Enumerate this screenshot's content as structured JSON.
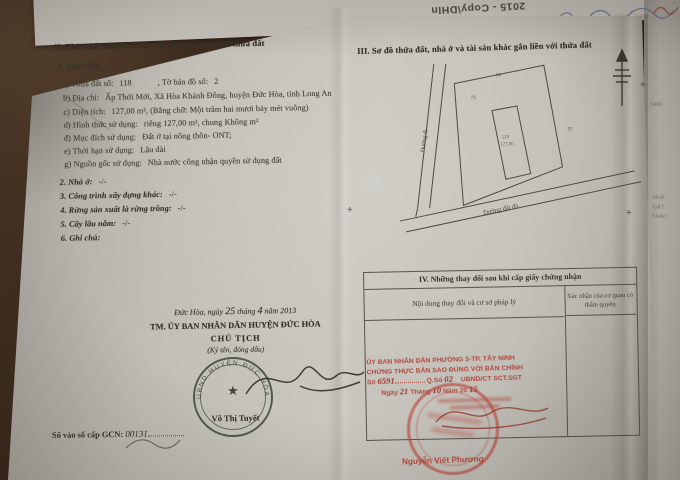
{
  "colors": {
    "backdrop_brown": "#3a2a1c",
    "paper": "#c6c3bc",
    "ink": "#45423b",
    "stamp_red": "#b2483d",
    "seal_dark": "#323d35"
  },
  "back_sheet": {
    "flipped_label": "2015 - Copy\\DHIn"
  },
  "edge_fragments": [
    "NAM",
    "NHA",
    "ĐẤT",
    "KHÁC"
  ],
  "section_ii": {
    "heading": "II. Thửa đất, nhà ở và tài sản khác gắn liền với thửa đất",
    "sub_heading": "1. Thửa đất:",
    "fields": [
      {
        "label": "a) Thửa đất số:",
        "value": "118",
        "label2": ", Tờ bản đồ số:",
        "value2": "2"
      },
      {
        "label": "b) Địa chỉ:",
        "value": "Ấp Thới Mới, Xã Hòa Khánh Đông, huyện Đức Hòa, tỉnh Long An"
      },
      {
        "label": "c) Diện tích:",
        "value": "127,00 m², (Bằng chữ: Một trăm hai mươi bảy mét vuông)"
      },
      {
        "label": "d) Hình thức sử dụng:",
        "value": "riêng 127,00    m², chung  Không    m²"
      },
      {
        "label": "đ) Mục đích sử dụng:",
        "value": "Đất ở tại nông thôn- ONT;"
      },
      {
        "label": "e) Thời hạn sử dụng:",
        "value": "Lâu dài"
      },
      {
        "label": "g) Nguồn gốc sử dụng:",
        "value": "Nhà nước công nhận quyền sử dụng đất"
      }
    ],
    "items": [
      {
        "label": "2. Nhà ở:",
        "value": "-/-"
      },
      {
        "label": "3. Công trình xây dựng khác:",
        "value": "-/-"
      },
      {
        "label": "4. Rừng sản xuất là rừng trồng:",
        "value": "-/-"
      },
      {
        "label": "5. Cây lâu năm:",
        "value": "-/-"
      },
      {
        "label": "6. Ghi chú:",
        "value": ""
      }
    ]
  },
  "section_iii": {
    "heading": "III. Sơ đồ thửa đất, nhà ở và tài sản khác gắn liền với thửa đất",
    "diagram": {
      "left_road": "Đường đi",
      "bottom_road": "Đường đất đỏ",
      "plot_number": "118",
      "plot_area": "127,00",
      "edge_top": "90",
      "edge_left": "73",
      "edge_right": "57"
    }
  },
  "section_iv": {
    "heading": "IV. Những thay đổi sau khi cấp giấy chứng nhận",
    "col_content": "Nội dung thay đổi và cơ sở pháp lý",
    "col_confirm": "Xác nhận của cơ quan có thẩm quyền"
  },
  "issuing": {
    "date_prefix": "Đức Hòa, ngày",
    "date_day": "25",
    "date_mid": "tháng",
    "date_month": "4",
    "date_suffix": "năm 2013",
    "authority": "TM. ỦY BAN NHÂN DÂN HUYỆN ĐỨC HÒA",
    "title": "CHỦ TỊCH",
    "sign_note": "(Ký tên, đóng dấu)",
    "seal_ring": "UBND HUYỆN ĐỨC HÒA",
    "seal_star": "★",
    "signer": "Võ Thị Tuyết"
  },
  "registry": {
    "label": "Số vào sổ cấp GCN:",
    "value": "00131"
  },
  "notary": {
    "line1": "ỦY BAN NHÂN DÂN PHƯỜNG 3-TP. TÂY NINH",
    "line2": "CHỨNG THỰC BẢN SAO ĐÚNG VỚI BẢN CHÍNH",
    "no_label": "Số",
    "no_value": "6591",
    "book_label": "Q.Sổ",
    "book_value": "02",
    "ref": "UBND/CT SCT.SGT",
    "date_ngay": "Ngày",
    "date_day": "21",
    "date_thang": "Tháng",
    "date_month": "10",
    "date_nam": "Năm 20",
    "date_year": "15",
    "signer": "Nguyễn Viết Phương"
  }
}
